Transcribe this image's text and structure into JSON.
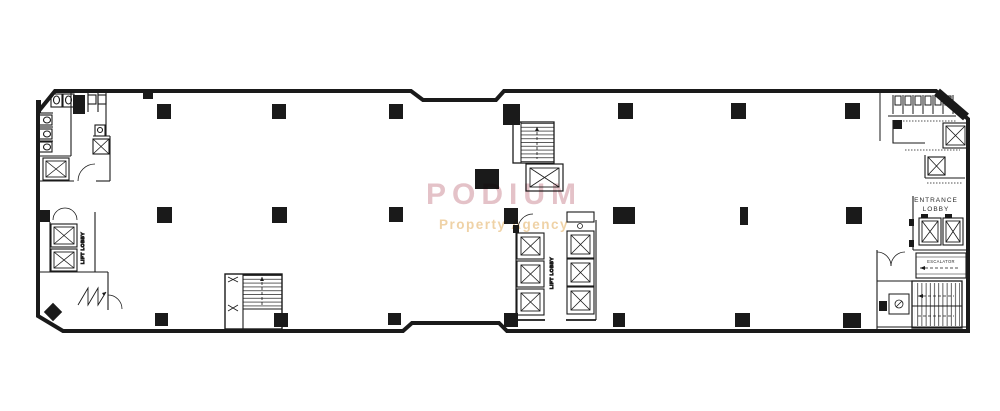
{
  "watermark": {
    "brand": "PODIUM",
    "tagline": "Property Agency",
    "brand_color": "#e0b8bf",
    "tagline_color": "#ecca97"
  },
  "plan": {
    "left_lift_lobby_label": "LIFT LOBBY",
    "central_lift_lobby_label": "LIFT LOBBY",
    "entrance_lobby_line1": "ENTRANCE",
    "entrance_lobby_line2": "LOBBY",
    "escalator_label": "ESCALATOR"
  },
  "colors": {
    "ink": "#1a1a1a",
    "paper": "#ffffff"
  }
}
